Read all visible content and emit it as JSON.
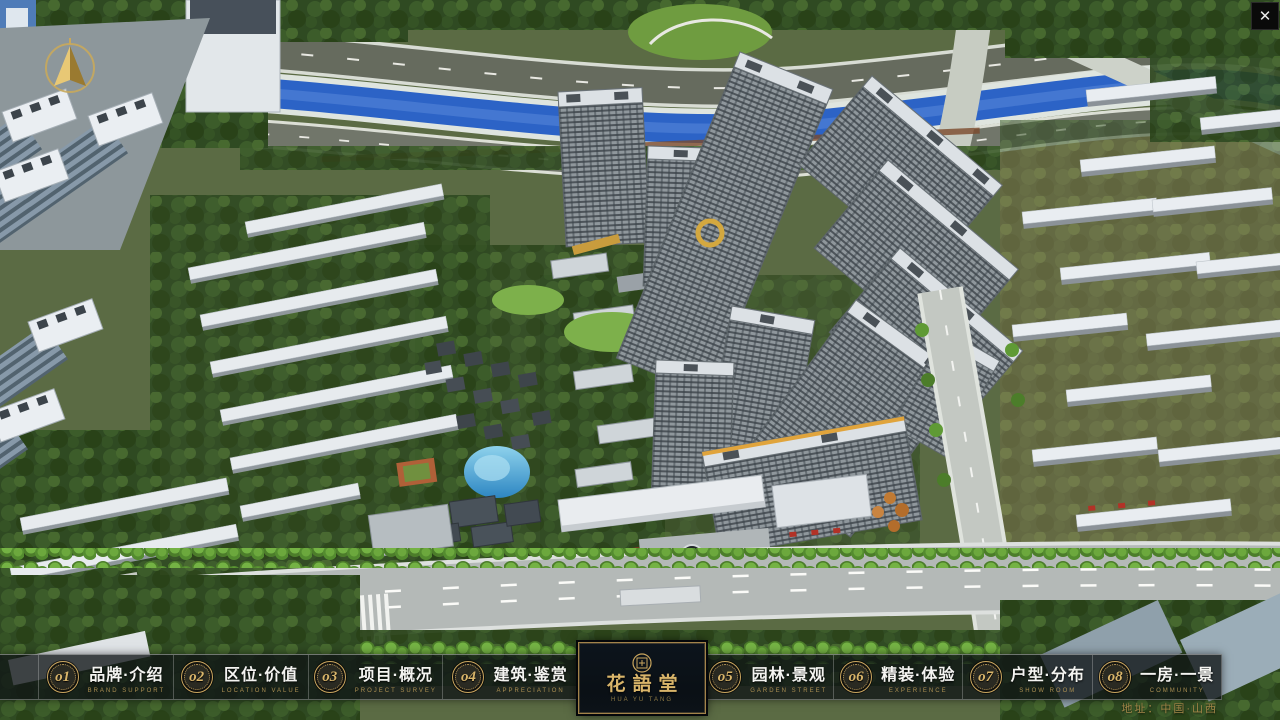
{
  "header": {
    "close_icon": "✕"
  },
  "logo": {
    "name": "花語堂",
    "subtext": "HUA YU TANG"
  },
  "nav": {
    "items": [
      {
        "num": "o1",
        "label": "品牌·介绍",
        "sub": "BRAND SUPPORT"
      },
      {
        "num": "o2",
        "label": "区位·价值",
        "sub": "LOCATION VALUE"
      },
      {
        "num": "o3",
        "label": "项目·概况",
        "sub": "PROJECT SURVEY"
      },
      {
        "num": "o4",
        "label": "建筑·鉴赏",
        "sub": "APPRECIATION"
      },
      {
        "num": "o5",
        "label": "园林·景观",
        "sub": "GARDEN STREET"
      },
      {
        "num": "o6",
        "label": "精装·体验",
        "sub": "EXPERIENCE"
      },
      {
        "num": "o7",
        "label": "户型·分布",
        "sub": "SHOW ROOM"
      },
      {
        "num": "o8",
        "label": "一房·一景",
        "sub": "COMMUNITY"
      }
    ]
  },
  "footer": {
    "address": "地址：中国·山西"
  },
  "icons": {
    "close": "close-icon",
    "compass": "compass-north-arrow-icon",
    "seal": "brand-seal-icon"
  },
  "colors": {
    "accent_gold": "#c9a55e",
    "bar_bg": "rgba(16,20,22,0.78)",
    "panel_bg": "#0b1118",
    "river": "#2c63c6",
    "foliage_dark": "#2f4a22",
    "foliage_bright": "#74b244",
    "road": "#b4b9b7",
    "tower_facade": "#8f979c"
  }
}
